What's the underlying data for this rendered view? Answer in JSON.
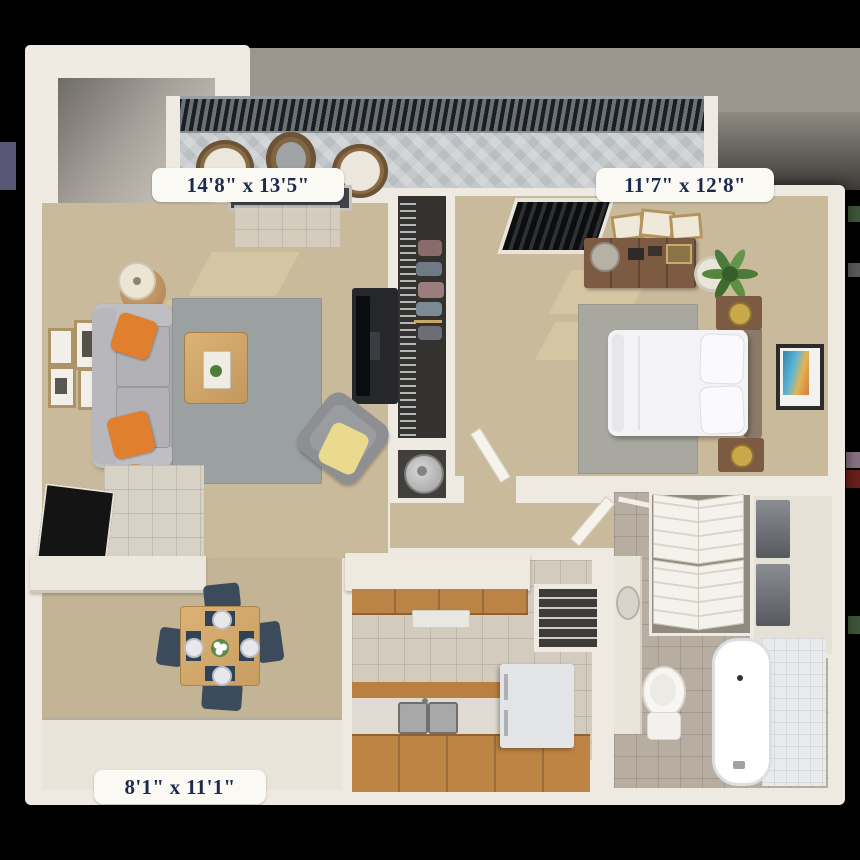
{
  "floor_plan": {
    "labels": {
      "living_room": "14'8\" x 13'5\"",
      "bedroom": "11'7\" x 12'8\"",
      "dining_room": "8'1\" x 11'1\""
    }
  },
  "palette": {
    "background": "#000000",
    "backdrop_gray": "#9b958d",
    "wall_cream": "#efeae1",
    "carpet_living": "#c9ba9b",
    "carpet_dining": "#c3b495",
    "tile_kitchen": "#d2cbbe",
    "tile_bathroom": "#b7ada0",
    "tile_entry": "#d8d2c6",
    "rug_living": "#9ba1a1",
    "rug_bedroom": "#a8a8a0",
    "sofa_gray": "#a9a9ad",
    "pillow_orange": "#e0802f",
    "throw_yellow": "#e9da8e",
    "wood_light": "#d6ab6e",
    "wood_cabinet": "#bc8347",
    "wood_furniture": "#7d5a42",
    "chair_navy": "#3b4b5c",
    "bed_white": "#f3f3f5",
    "plant_green": "#4c7a38",
    "art_teal": "#2e86b0",
    "appliance_white": "#e2e4e6",
    "deck_gray": "#b9bec1",
    "railing_dark": "#23262a",
    "door_black": "#141415",
    "label_bg": "#fbf9f4",
    "label_text": "#1c2b4d"
  }
}
